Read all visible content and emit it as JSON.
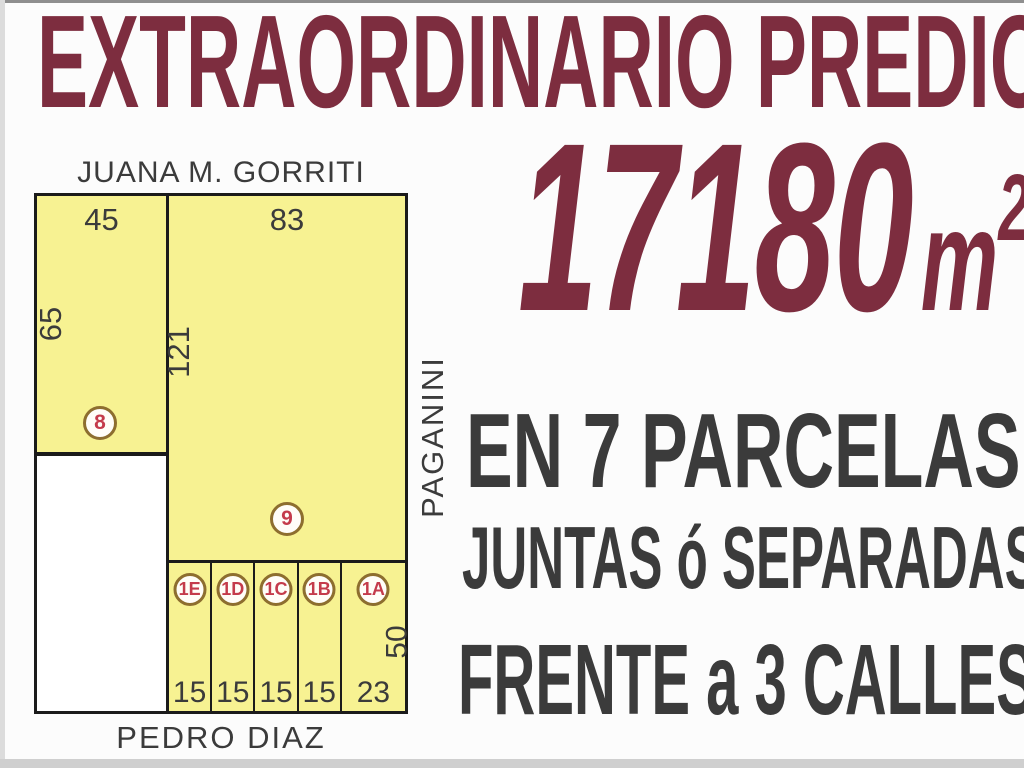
{
  "colors": {
    "maroon": "#7d2d3f",
    "dark": "#3b3b3b",
    "yellow": "#f7f292",
    "line": "#1b1b1b",
    "ring": "#8d6e2f",
    "red": "#c43b4b",
    "bg": "#fcfcfc"
  },
  "header": {
    "title": "EXTRAORDINARIO PREDIO"
  },
  "area": {
    "value": "17180",
    "unit": "m",
    "exponent": "2"
  },
  "claims": {
    "parcels": "EN 7 PARCELAS",
    "together": "JUNTAS ó SEPARADAS",
    "frontage": "FRENTE a 3 CALLES"
  },
  "diagram": {
    "streets": {
      "top": "JUANA M. GORRITI",
      "right": "PAGANINI",
      "bottom": "PEDRO DIAZ"
    },
    "parcel_8": {
      "id": "8",
      "front": "45",
      "depth": "65"
    },
    "parcel_9": {
      "id": "9",
      "front": "83",
      "depth": "121"
    },
    "small_parcels": [
      {
        "id": "1E",
        "front": "15"
      },
      {
        "id": "1D",
        "front": "15"
      },
      {
        "id": "1C",
        "front": "15"
      },
      {
        "id": "1B",
        "front": "15"
      },
      {
        "id": "1A",
        "front": "23",
        "depth": "50"
      }
    ]
  }
}
